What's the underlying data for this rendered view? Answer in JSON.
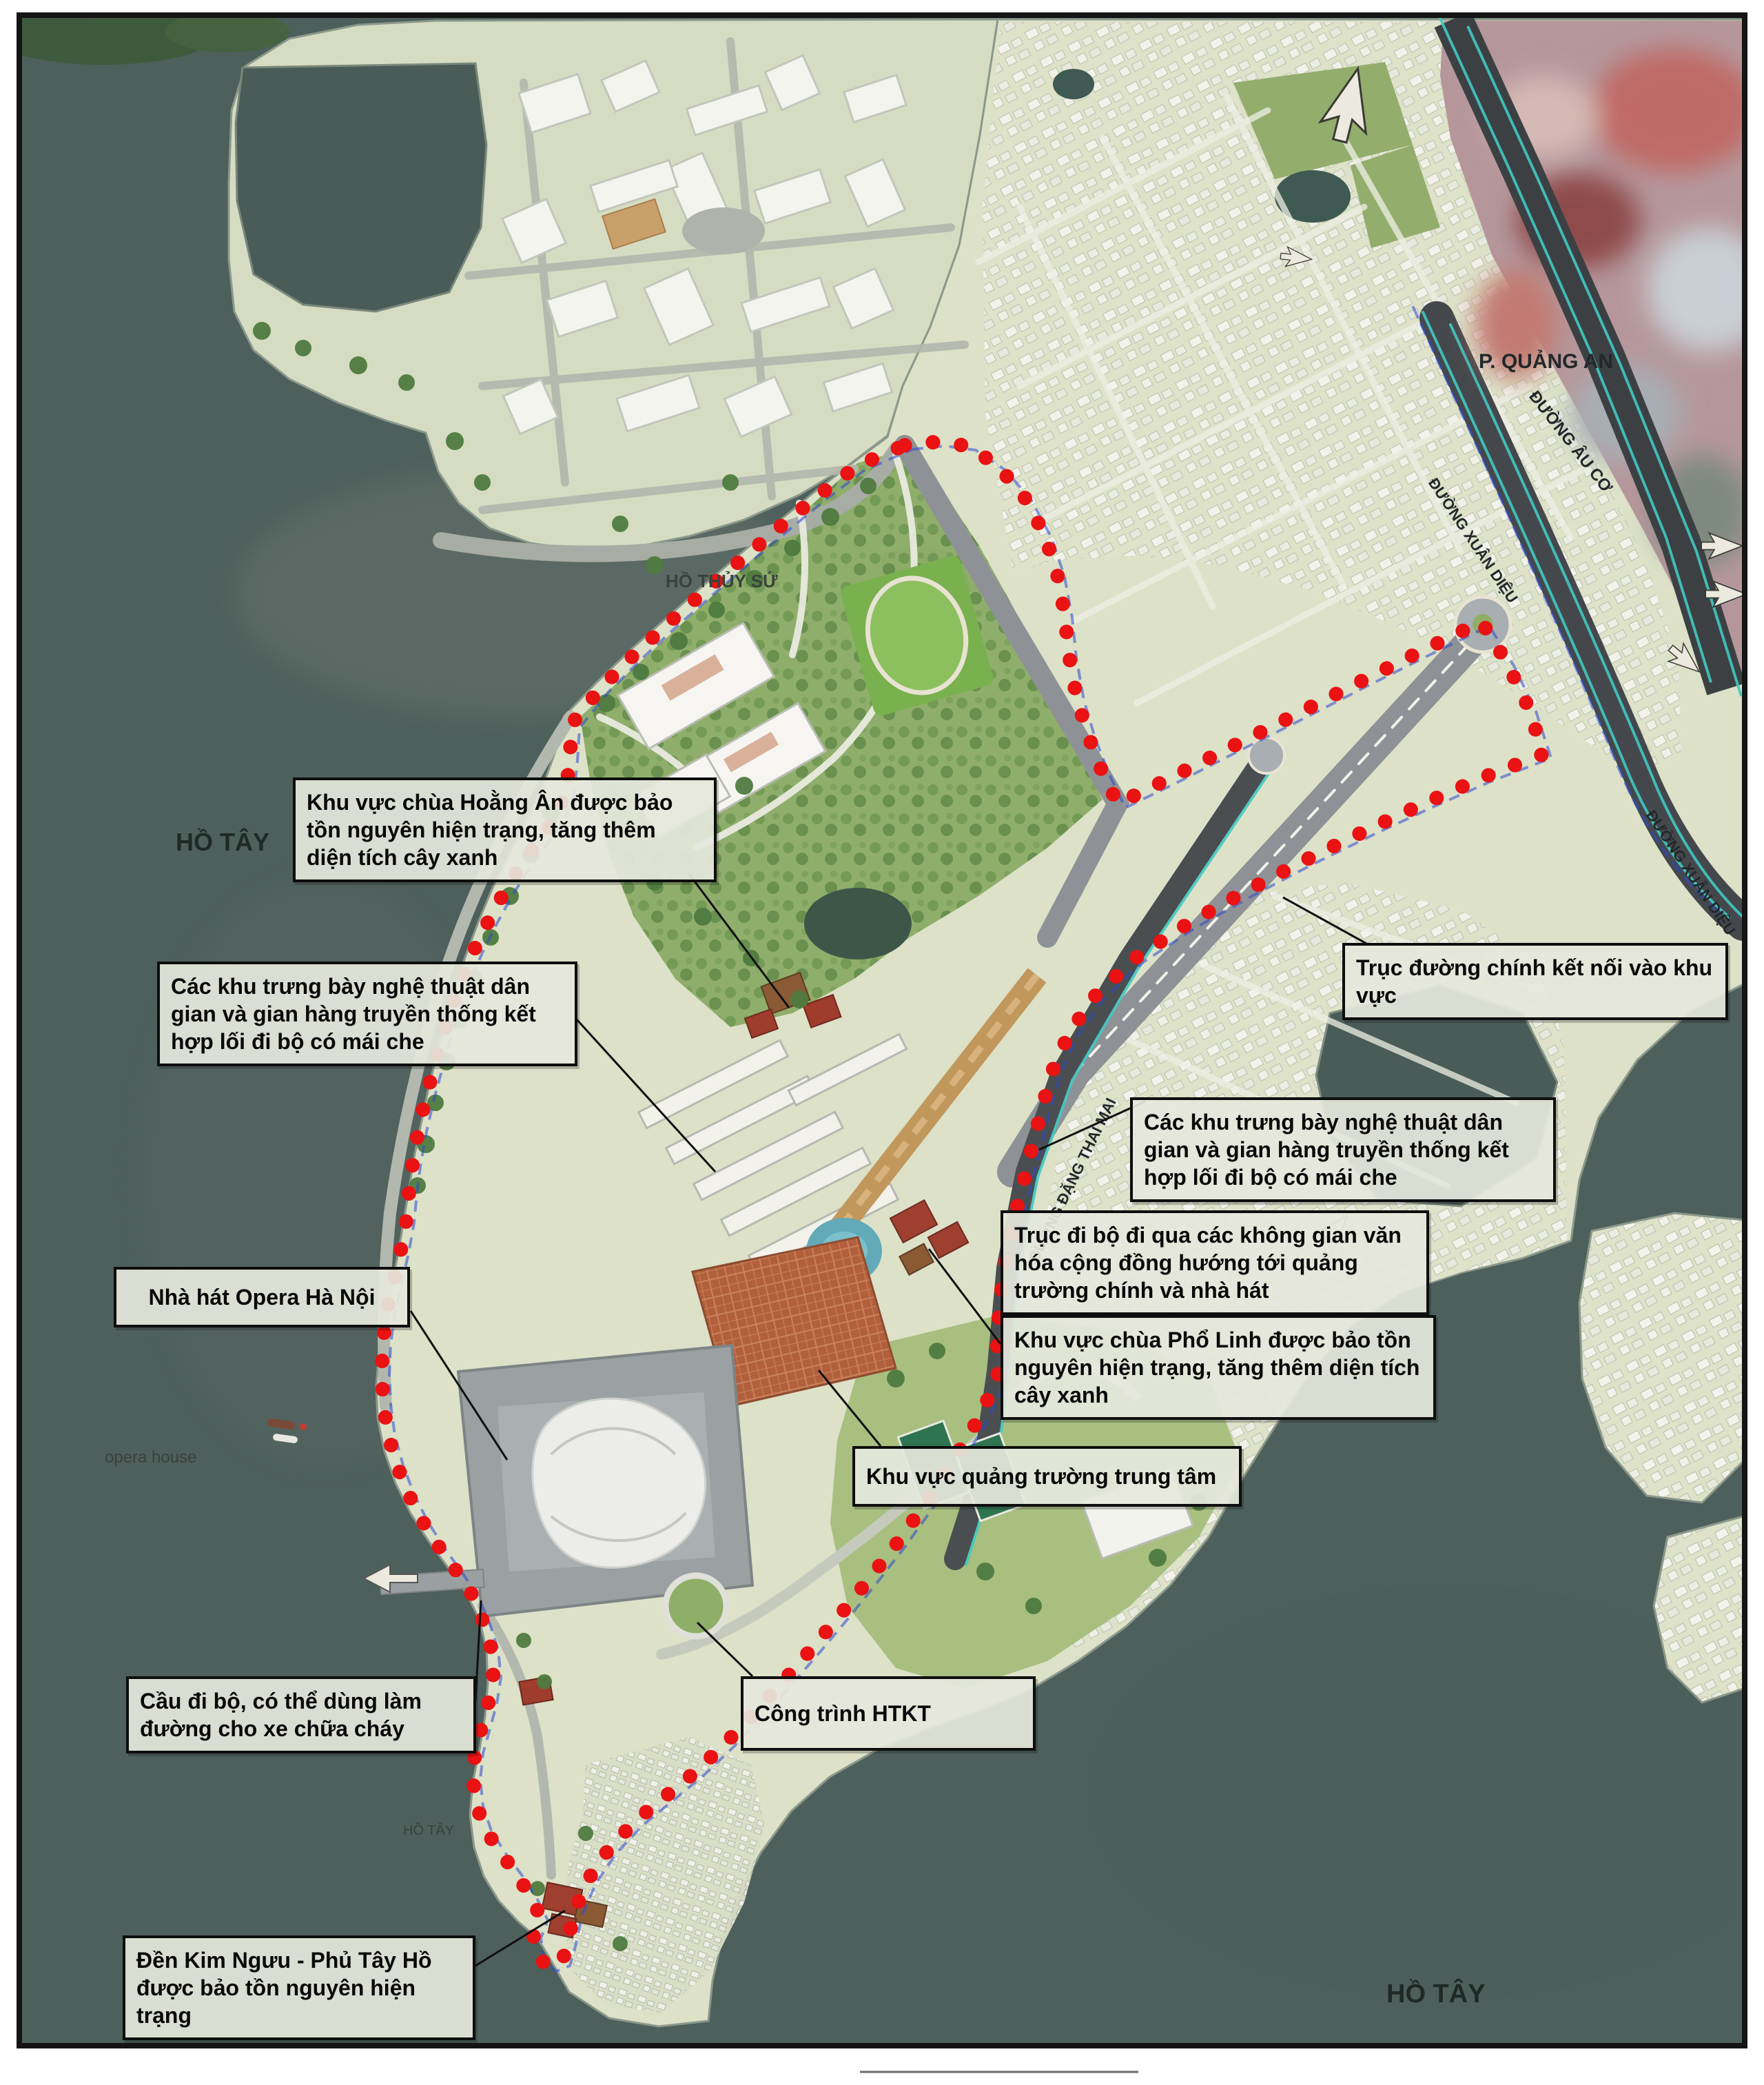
{
  "map": {
    "water_labels": {
      "ho_tay_west": "HỒ TÂY",
      "ho_tay_south": "HỒ TÂY",
      "ho_tay_small": "HỒ TÂY",
      "ho_thuy_su": "HỒ THỦY SỨ"
    },
    "district_label": "P. QUẢNG AN",
    "poi_label": "opera house",
    "road_labels": {
      "au_co": "ĐƯỜNG ÂU CƠ",
      "xuan_dieu_north": "ĐƯỜNG XUÂN DIỆU",
      "xuan_dieu_east": "ĐƯỜNG XUÂN DIỆU",
      "dang_thai_mai": "ĐƯỜNG ĐẶNG THAI MAI"
    },
    "callouts": [
      {
        "id": "hoang-an",
        "text": "Khu vực chùa Hoằng Ân được bảo tồn nguyên hiện trạng, tăng thêm diện tích cây xanh"
      },
      {
        "id": "trung-bay-left",
        "text": "Các khu trưng bày nghệ thuật dân gian và gian hàng truyền thống kết hợp lối đi bộ có mái che"
      },
      {
        "id": "truc-duong-chinh",
        "text": "Trục đường chính kết nối vào khu vực"
      },
      {
        "id": "trung-bay-right",
        "text": "Các khu trưng bày nghệ thuật dân gian và gian hàng truyền thống kết hợp lối đi bộ có mái che"
      },
      {
        "id": "truc-di-bo",
        "text": "Trục đi bộ đi qua các không gian văn hóa cộng đồng hướng tới quảng trường chính và nhà hát"
      },
      {
        "id": "pho-linh",
        "text": "Khu vực chùa Phổ Linh được bảo tồn nguyên hiện trạng, tăng thêm diện tích cây xanh"
      },
      {
        "id": "quang-truong",
        "text": "Khu vực quảng trường trung tâm"
      },
      {
        "id": "opera",
        "text": "Nhà hát Opera Hà Nội"
      },
      {
        "id": "cau-di-bo",
        "text": "Cầu đi bộ, có thể dùng làm đường cho xe chữa cháy"
      },
      {
        "id": "htkt",
        "text": "Công trình HTKT"
      },
      {
        "id": "kim-nguu",
        "text": "Đền Kim Ngưu - Phủ Tây Hồ được bảo tồn nguyên hiện trạng"
      }
    ],
    "colors": {
      "water": "#4e605c",
      "land": "#dce1c8",
      "park": "#8cab66",
      "road_dark": "#42464a",
      "road_light": "#a7aca4",
      "boundary_red": "#ea1212",
      "guide_blue": "#2b49cf",
      "teal_edge": "#41c9c2",
      "callout_bg": "#e5e7db",
      "callout_border": "#0e0e0e",
      "axis_tan": "#c2975c",
      "plaza_terracotta": "#b2603c",
      "pool_blue": "#62aab8"
    }
  }
}
